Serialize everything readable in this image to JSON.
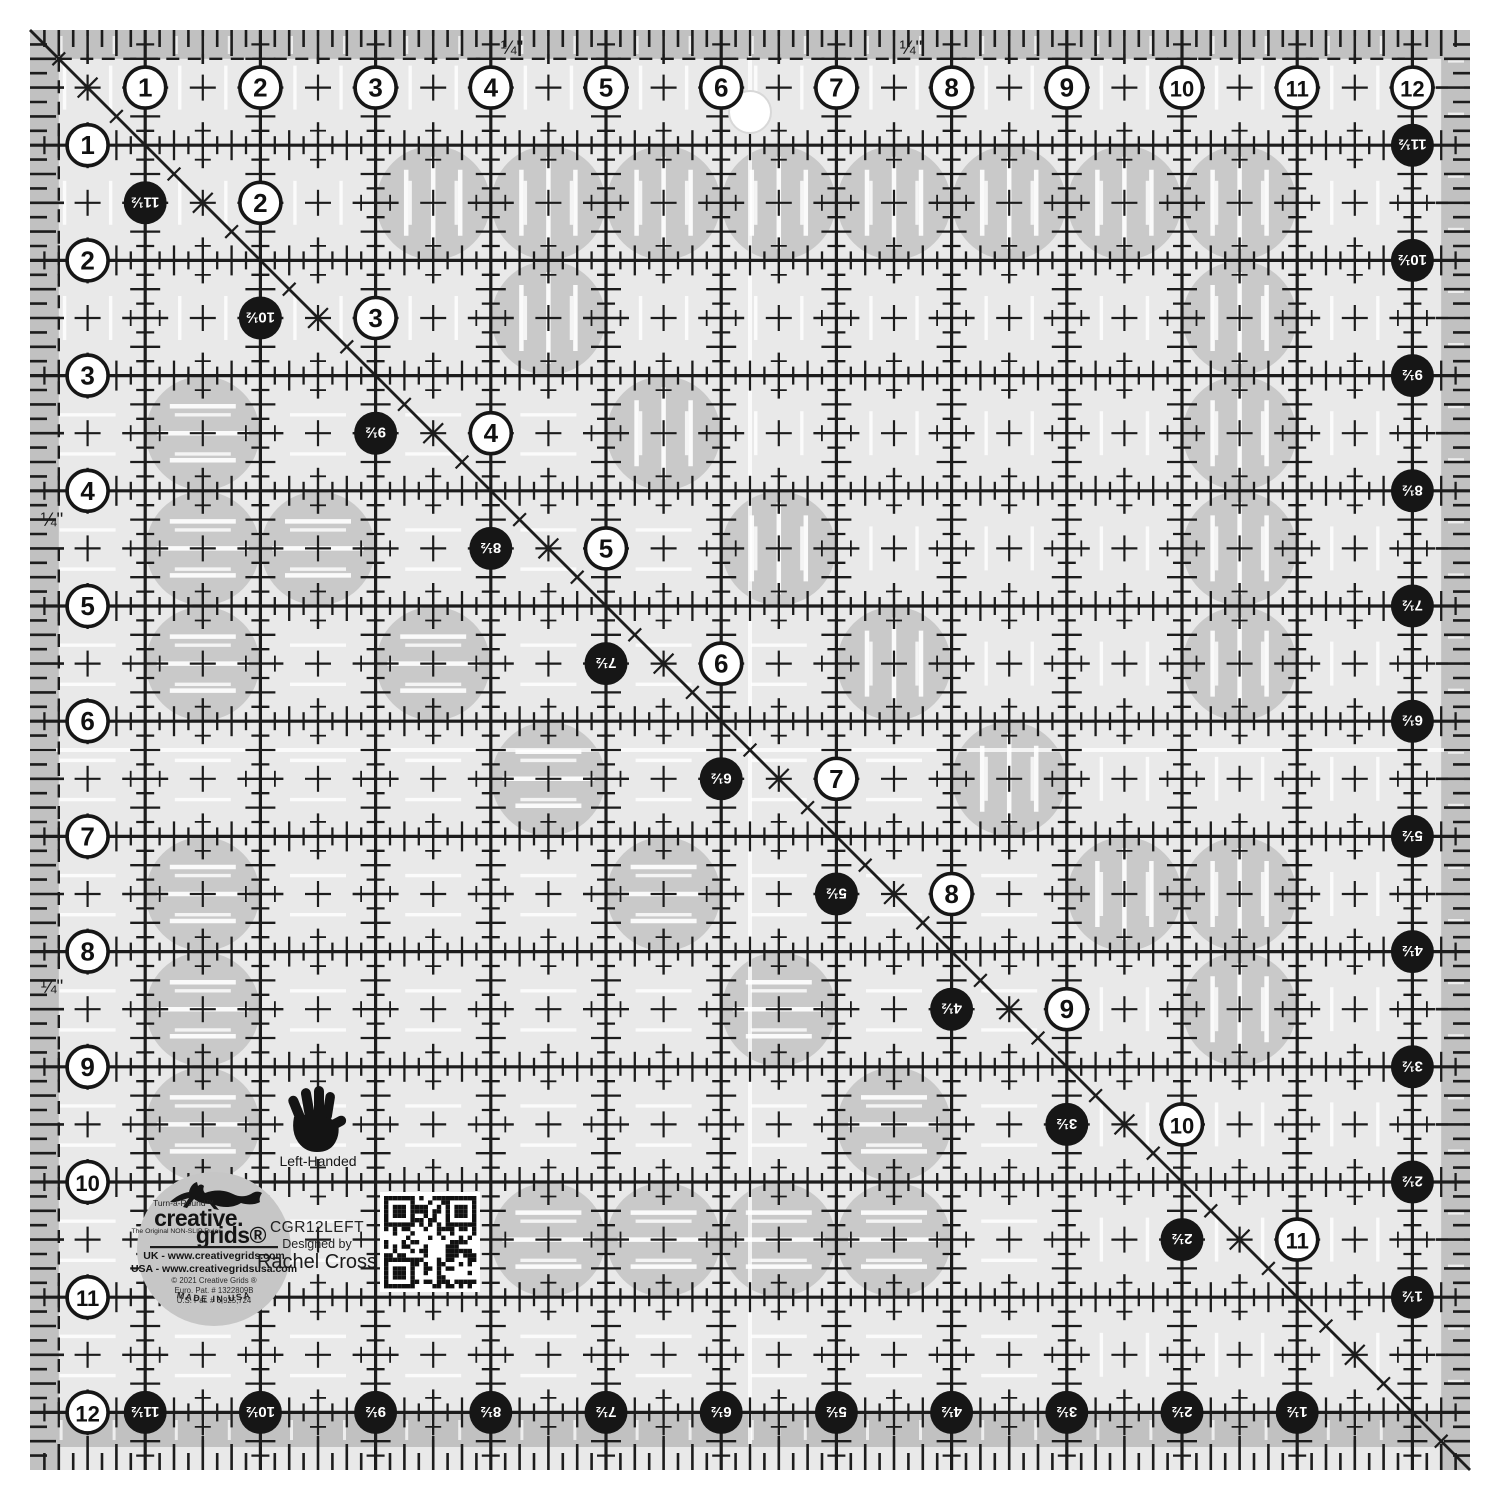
{
  "colors": {
    "body": "#e9e9e9",
    "band": "#c1c1c1",
    "grip": "#c9c9c9",
    "logo_gray": "#c6c6c6",
    "ink": "#1c1c1c",
    "white": "#ffffff"
  },
  "labels": {
    "model": "CGR12LEFT",
    "designed_by": "Designed by",
    "designer": "Rachel Cross",
    "left_handed": "Left-Handed"
  },
  "logo": {
    "tagline": "Turn-a-Round™",
    "name1": "creative.",
    "name2": "grids®",
    "subtitle": "The Original NON-SLIP Ruler",
    "uk_line": "UK - www.creativegrids.com",
    "usa_line": "USA - www.creativegridsusa.com",
    "copyright": "© 2021 Creative Grids ®",
    "euro_pat": "Euro. Pat. # 1322809B",
    "us_pat": "U.S. Pat. # 6,925,724",
    "made_in": "MADE IN USA"
  },
  "scale": {
    "size_inches": 12.5,
    "quarter_label": "¼\"",
    "top_numbers": [
      "1",
      "2",
      "3",
      "4",
      "5",
      "6",
      "7",
      "8",
      "9",
      "10",
      "11",
      "12"
    ],
    "left_numbers": [
      "1",
      "2",
      "3",
      "4",
      "5",
      "6",
      "7",
      "8",
      "9",
      "10",
      "11",
      "12"
    ],
    "right_numbers": [
      "11½",
      "10½",
      "9½",
      "8½",
      "7½",
      "6½",
      "5½",
      "4½",
      "3½",
      "2½",
      "1½"
    ],
    "bottom_numbers": [
      "11½",
      "10½",
      "9½",
      "8½",
      "7½",
      "6½",
      "5½",
      "4½",
      "3½",
      "2½",
      "1½"
    ],
    "diagonal_white_numbers": [
      "2",
      "3",
      "4",
      "5",
      "6",
      "7",
      "8",
      "9",
      "10",
      "11"
    ],
    "diagonal_black_numbers": [
      "11½",
      "10½",
      "9½",
      "8½",
      "7½",
      "6½",
      "5½",
      "4½",
      "3½",
      "2½"
    ]
  },
  "grips": [
    [
      3.5,
      1.5,
      "v"
    ],
    [
      4.5,
      1.5,
      "v"
    ],
    [
      5.5,
      1.5,
      "v"
    ],
    [
      6.5,
      1.5,
      "v"
    ],
    [
      7.5,
      1.5,
      "v"
    ],
    [
      8.5,
      1.5,
      "v"
    ],
    [
      9.5,
      1.5,
      "v"
    ],
    [
      10.5,
      1.5,
      "v"
    ],
    [
      4.5,
      2.5,
      "v"
    ],
    [
      10.5,
      2.5,
      "v"
    ],
    [
      1.5,
      3.5,
      "h"
    ],
    [
      5.5,
      3.5,
      "v"
    ],
    [
      10.5,
      3.5,
      "v"
    ],
    [
      1.5,
      4.5,
      "h"
    ],
    [
      2.5,
      4.5,
      "h"
    ],
    [
      6.5,
      4.5,
      "v"
    ],
    [
      10.5,
      4.5,
      "v"
    ],
    [
      1.5,
      5.5,
      "h"
    ],
    [
      3.5,
      5.5,
      "h"
    ],
    [
      7.5,
      5.5,
      "v"
    ],
    [
      10.5,
      5.5,
      "v"
    ],
    [
      4.5,
      6.5,
      "h"
    ],
    [
      8.5,
      6.5,
      "v"
    ],
    [
      1.5,
      7.5,
      "h"
    ],
    [
      5.5,
      7.5,
      "h"
    ],
    [
      9.5,
      7.5,
      "v"
    ],
    [
      10.5,
      7.5,
      "v"
    ],
    [
      1.5,
      8.5,
      "h"
    ],
    [
      6.5,
      8.5,
      "h"
    ],
    [
      10.5,
      8.5,
      "v"
    ],
    [
      1.5,
      9.5,
      "h"
    ],
    [
      7.5,
      9.5,
      "h"
    ],
    [
      4.5,
      10.5,
      "h"
    ],
    [
      5.5,
      10.5,
      "h"
    ],
    [
      6.5,
      10.5,
      "h"
    ],
    [
      7.5,
      10.5,
      "h"
    ]
  ]
}
